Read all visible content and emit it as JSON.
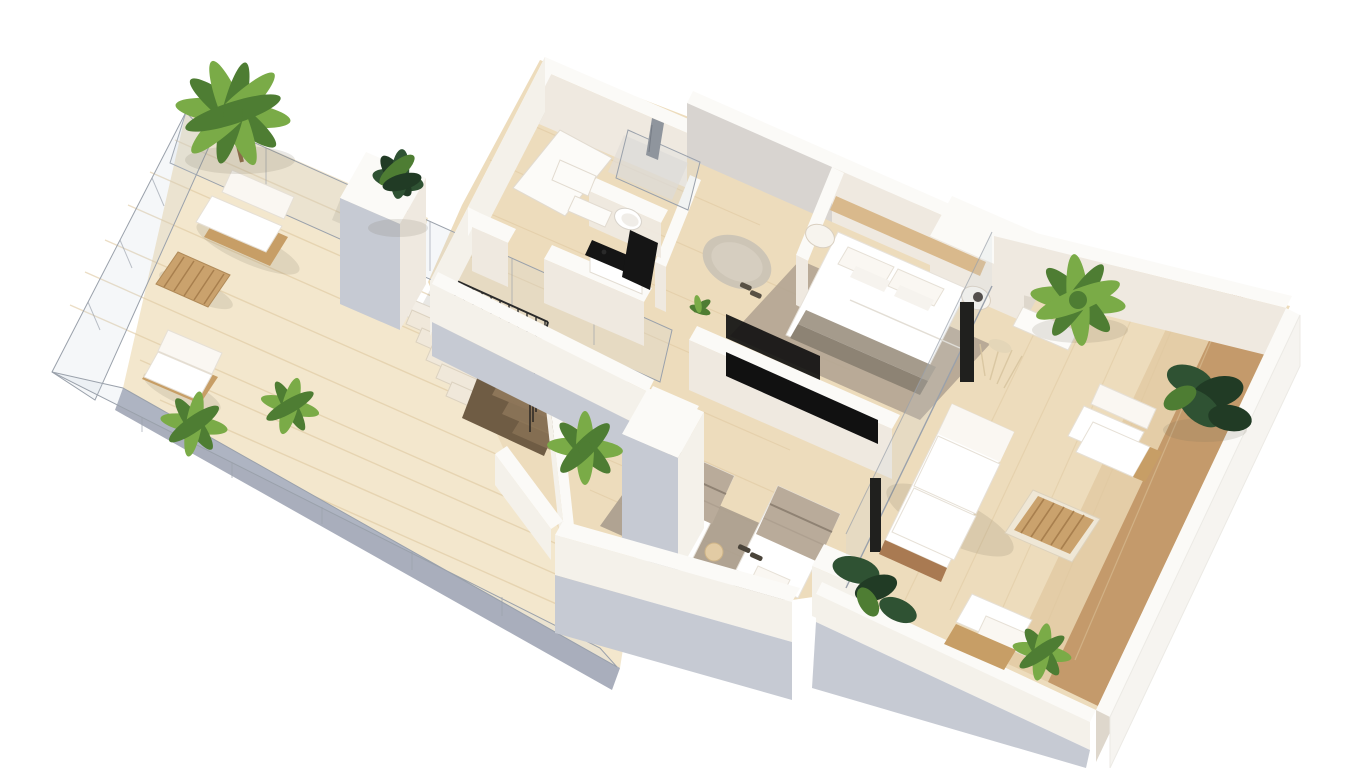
{
  "meta": {
    "title": "3D isometric floor plan rendering of an apartment upper floor with two terraces",
    "style": "photorealistic cutaway dollhouse view, white background"
  },
  "colors": {
    "bg": "#ffffff",
    "wood_light": "#eddcbc",
    "wood_pale": "#f3e7cd",
    "wood_mid": "#dfc49b",
    "wood_dark": "#c49a6b",
    "slab_edge": "#a9aebc",
    "wall_top": "#fbfaf7",
    "wall_white": "#f4f1ea",
    "wall_light": "#efe9e0",
    "wall_shade": "#ded7cc",
    "wall_cool": "#c6cad3",
    "glass_line": "#9aa1ab",
    "glass_fill": "rgba(198,210,220,0.18)",
    "rug_warm": "#b3a492",
    "rug_round": "#cdc5b6",
    "rug_gray": "#a89c8d",
    "bed_white": "#ffffff",
    "soft_white": "#faf7f2",
    "cushion_edge": "#e6e0d6",
    "stripe_light": "#a59b8c",
    "stripe_dark": "#8d8374",
    "blanket_beige": "#b9ab9a",
    "rattan": "#c79e66",
    "rattan_dark": "#a97a52",
    "slat_wood": "#caa26d",
    "slat_line": "#a87f4e",
    "plank_line": "#dfc8a0",
    "plant_green": "#7aab47",
    "plant_green_dark": "#4e7d33",
    "plant_ficus": "#2f5233",
    "plant_ficus_dark": "#213b25",
    "stair_void": "#6f5c44",
    "stair_step": "#f0e8da",
    "stair_inner": "#8d7659",
    "baluster": "#1c1c1c",
    "tv_black": "#111111",
    "counter_black": "#151515",
    "shower_gray": "#d8d4d0",
    "towel_gray": "#8f959d",
    "shadow_soft": "rgba(120,110,95,0.16)"
  },
  "scene": {
    "rooms": [
      {
        "id": "terrace-left",
        "label": "Left terrace",
        "features": [
          "glass railing",
          "outdoor sofa",
          "slatted coffee table",
          "lounge armchair",
          "large palm tree",
          "potted plants",
          "wood decking"
        ]
      },
      {
        "id": "entry-hall",
        "label": "Entry hall",
        "features": [
          "switchback staircase",
          "black balusters",
          "stairwell opening"
        ]
      },
      {
        "id": "bathroom",
        "label": "Bathroom",
        "features": [
          "walk-in shower with glass screen",
          "hanging towel",
          "toilet",
          "vanity with black countertop",
          "dark mirror panel"
        ]
      },
      {
        "id": "wardrobe",
        "label": "Wardrobe area",
        "features": [
          "white sliding panels",
          "leaning door"
        ]
      },
      {
        "id": "master-bedroom",
        "label": "Master bedroom",
        "features": [
          "double bed with striped runner",
          "wood headboard panel",
          "round rug with slippers",
          "nightstands",
          "black media wall",
          "glass door to terrace"
        ]
      },
      {
        "id": "second-bedroom",
        "label": "Second bedroom",
        "features": [
          "two single beds",
          "beige blankets",
          "slippers",
          "bedside stool",
          "area rug",
          "glass door to terrace"
        ]
      },
      {
        "id": "terrace-right",
        "label": "Right terrace",
        "features": [
          "outdoor sofa",
          "two lounge armchairs",
          "slatted coffee table",
          "side console",
          "pampas grass",
          "palm trees",
          "ficus plants",
          "two-tone decking"
        ]
      }
    ]
  }
}
